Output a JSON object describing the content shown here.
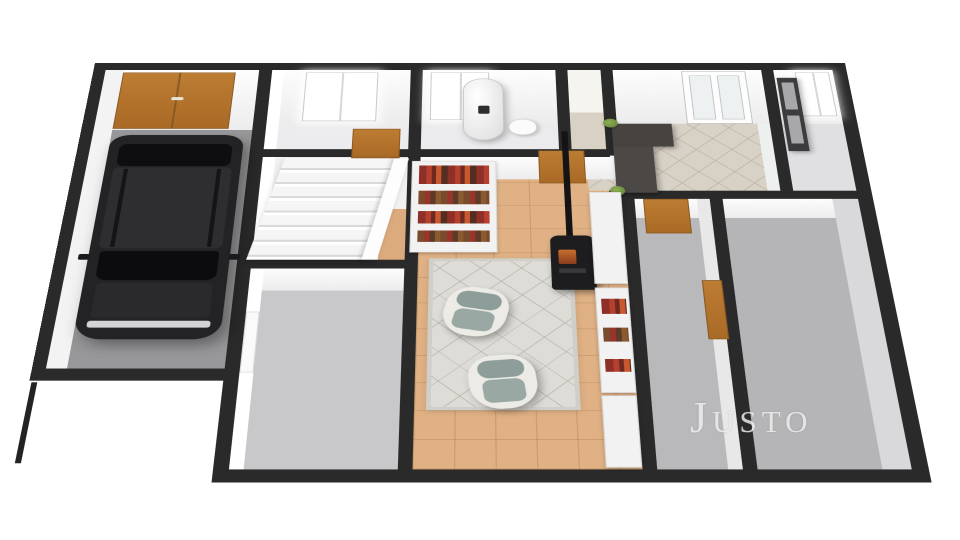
{
  "watermark": {
    "text": "Justo"
  },
  "scene": {
    "type": "3d-floor-plan-render",
    "view": "isometric-top-down",
    "background": "#ffffff",
    "rooms": [
      {
        "id": "garage",
        "floor_color": "#98989a",
        "features": [
          "double-garage-door",
          "black-suv"
        ]
      },
      {
        "id": "bedroom-top-left",
        "floor_color": "#ececee",
        "features": [
          "window",
          "brown-door"
        ]
      },
      {
        "id": "stair-hall",
        "floor_color": "#f1f1f2",
        "features": [
          "staircase"
        ]
      },
      {
        "id": "room-bottom-left",
        "floor_color": "#c8c8ca",
        "features": [
          "white-door"
        ]
      },
      {
        "id": "bathroom",
        "floor_color": "#ebebed",
        "features": [
          "window",
          "water-heater",
          "toilet"
        ]
      },
      {
        "id": "closet",
        "floor_color": "#d9d1c3",
        "features": []
      },
      {
        "id": "living-room",
        "floor_color": "#e0b185",
        "features": [
          "rug",
          "two-armchairs",
          "bookshelf",
          "wood-stove"
        ]
      },
      {
        "id": "hallway",
        "floor_color": "#d8d2c6",
        "features": [
          "desk",
          "shelving-unit",
          "plants"
        ]
      },
      {
        "id": "entry-room",
        "floor_color": "#d8d2c6",
        "features": [
          "french-door",
          "desk",
          "wardrobe"
        ]
      },
      {
        "id": "small-room-top-right",
        "floor_color": "#e0e0e2",
        "features": [
          "window",
          "wardrobe-mirror"
        ]
      },
      {
        "id": "bedroom-right-1",
        "floor_color": "#b9b9bb",
        "features": [
          "brown-door",
          "brown-door-side"
        ]
      },
      {
        "id": "bedroom-right-2",
        "floor_color": "#b5b5b7",
        "features": []
      }
    ],
    "furniture": [
      "black-suv",
      "armchair",
      "armchair",
      "bookshelf",
      "wood-stove-with-chimney",
      "water-heater",
      "toilet",
      "staircase",
      "desk",
      "wardrobe",
      "shelving-unit",
      "plants"
    ],
    "palette": {
      "wall": "#2a2a2b",
      "wall_inner_face": "#fbfbfb",
      "door_brown": "#b5752f",
      "living_tile": "#e0b185",
      "entry_tile": "#d8d2c6",
      "rug": "#dddcd6",
      "garage_floor": "#98989a",
      "bedroom_floor": "#b9b9bb",
      "car_body": "#232326",
      "stove": "#1d1d1f",
      "books_red": "#b5402e",
      "plant_green": "#6a8f3f",
      "watermark_gray": "#ededed"
    }
  }
}
